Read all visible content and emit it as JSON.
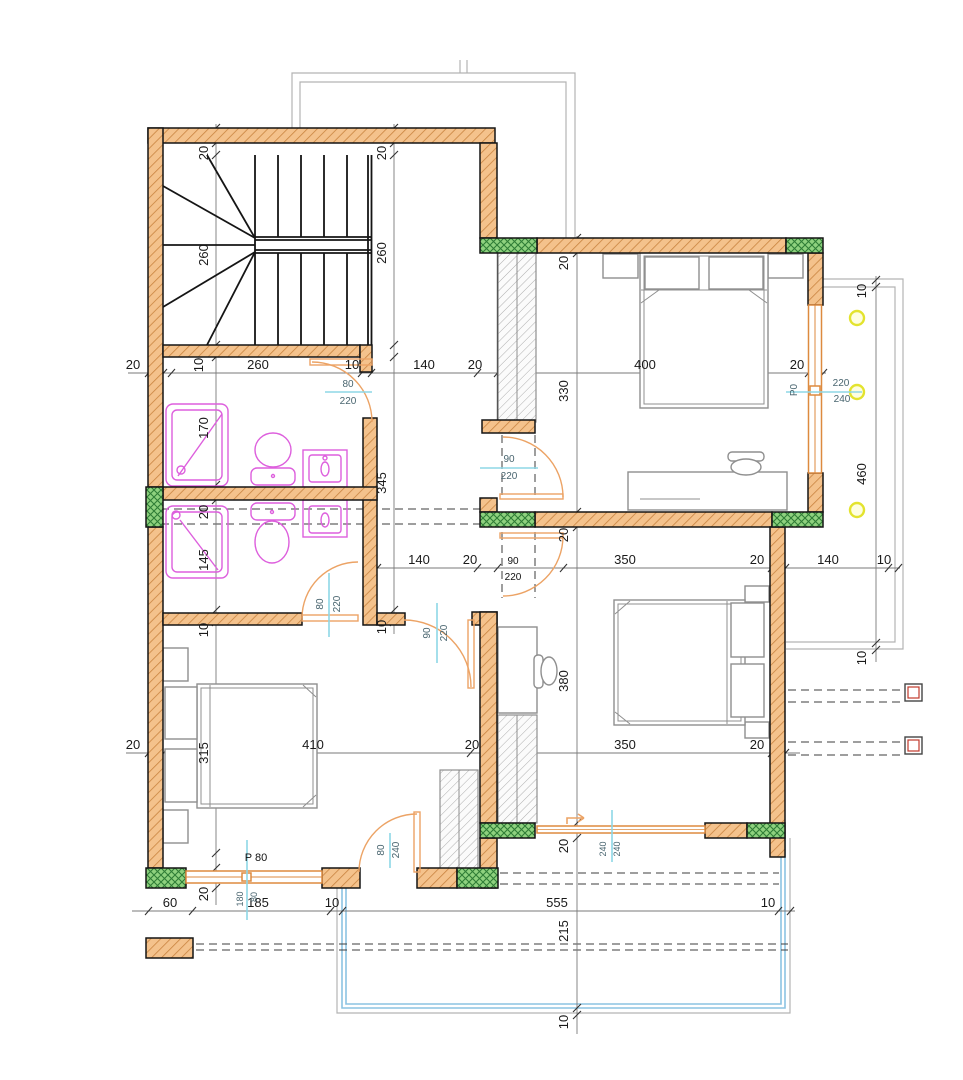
{
  "drawing": {
    "type": "architectural-floor-plan",
    "units": "cm"
  },
  "colors": {
    "wall_fill": "#f4c28c",
    "wall_hatch": "#c98440",
    "wall_edge": "#151515",
    "column_fill": "#8ed17e",
    "column_hatch": "#2f7d36",
    "fixture": "#dd5fdd",
    "door": "#eca365",
    "window": "#dd8a3f",
    "tag_line": "#8ed7e6",
    "tag_text": "#49656f",
    "dim_line": "#7a7a7a",
    "dim_text": "#1a1a1a",
    "outline": "#b3b3b3",
    "terrace": "#8cc3e2",
    "dash": "#3c3c3c",
    "beam_box": "#c0392b",
    "lamp": "#e3e32e",
    "closet_line": "#9a9a9a",
    "furniture": "#8f8f8f"
  },
  "chains": {
    "top": [
      "20",
      "10",
      "260",
      "10",
      "140",
      "20",
      "400",
      "20"
    ],
    "mid": [
      "140",
      "20",
      "350",
      "20",
      "140",
      "10"
    ],
    "mid_door": {
      "w": "90",
      "h": "220"
    },
    "lower": [
      "20",
      "410",
      "20",
      "350",
      "20"
    ],
    "bottom": [
      "60",
      "185",
      "10",
      "555",
      "10"
    ],
    "stairs_col": [
      "20",
      "260",
      "170",
      "20",
      "145",
      "10",
      "315",
      "20"
    ],
    "hall_col": [
      "20",
      "260",
      "345",
      "10"
    ],
    "center_col": [
      "20",
      "330",
      "20",
      "380",
      "20",
      "215",
      "10"
    ],
    "balcony_col": [
      "10",
      "460",
      "10"
    ]
  },
  "doors": [
    {
      "id": "bathroom-upper",
      "w": "80",
      "h": "220"
    },
    {
      "id": "bedroom-top",
      "w": "90",
      "h": "220"
    },
    {
      "id": "bathroom-lower",
      "w": "80",
      "h": "220"
    },
    {
      "id": "bedroom-left",
      "w": "90",
      "h": "220"
    },
    {
      "id": "terrace-door",
      "w": "80",
      "h": "240"
    }
  ],
  "windows": [
    {
      "id": "P0",
      "label": "P0",
      "w": "220",
      "h": "240"
    },
    {
      "id": "P80",
      "label": "P 80",
      "w": "180",
      "h": "80"
    },
    {
      "id": "W240",
      "w": "240",
      "h": "240"
    }
  ]
}
